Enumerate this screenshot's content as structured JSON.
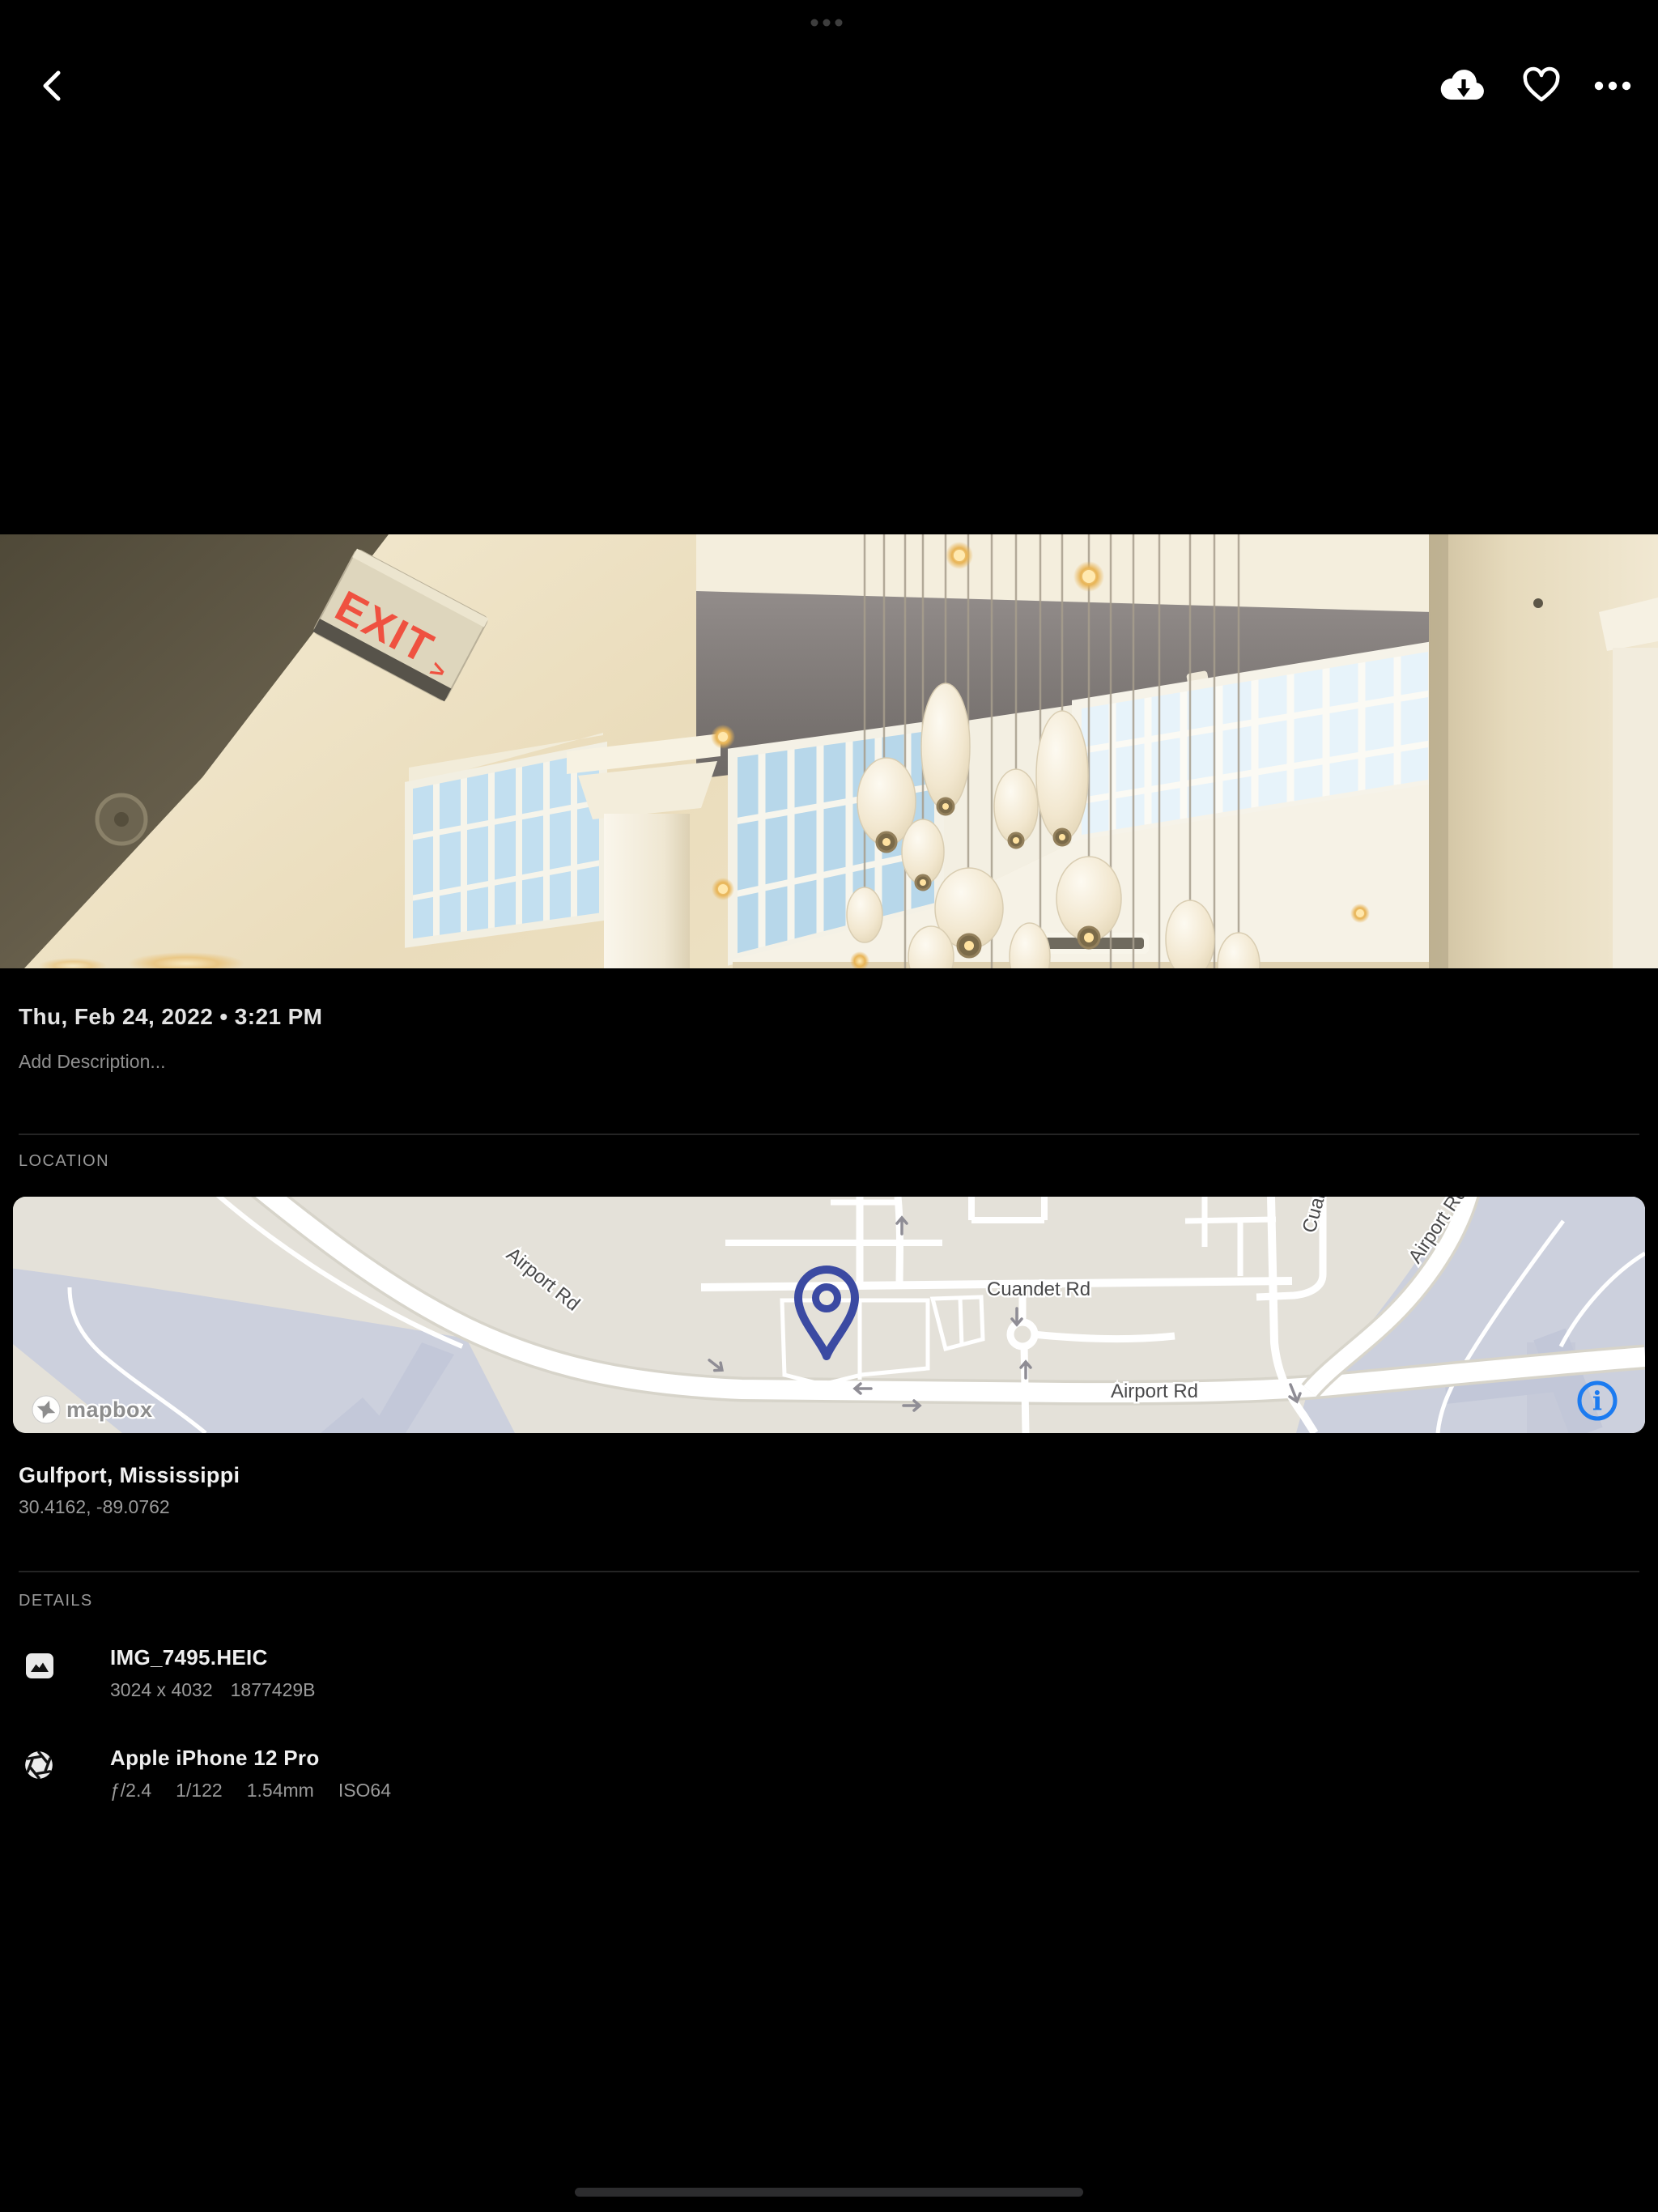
{
  "top_bar": {
    "back_icon": "chevron-left",
    "download_icon": "cloud-download",
    "favorite_icon": "heart-outline",
    "more_icon": "ellipsis-horizontal",
    "multitask_indicator_icon": "three-dots"
  },
  "photo": {
    "exit_sign_text": "EXIT",
    "exit_sign_arrow": ">"
  },
  "meta": {
    "datetime": "Thu, Feb 24, 2022 • 3:21 PM",
    "description_placeholder": "Add Description..."
  },
  "location": {
    "section_label": "LOCATION",
    "place": "Gulfport, Mississippi",
    "coordinates": "30.4162, -89.0762",
    "map": {
      "road_labels": {
        "airport_diagonal": "Airport Rd",
        "cuandet": "Cuandet Rd",
        "airport_bottom": "Airport Rd",
        "airport_right_partial": "Airport Rd",
        "cuandet_top_partial": "Cuandet Rd"
      },
      "attribution": "mapbox",
      "info_symbol": "i",
      "land_color": "#e4e1d9",
      "zone_color": "#ccd0dd",
      "pin_color": "#3b4aa2",
      "info_color": "#1c7bf0"
    }
  },
  "details": {
    "section_label": "DETAILS",
    "file": {
      "name": "IMG_7495.HEIC",
      "dimensions": "3024 x 4032",
      "size": "1877429B"
    },
    "camera": {
      "model": "Apple iPhone 12 Pro",
      "aperture": "ƒ/2.4",
      "shutter_speed": "1/122",
      "focal_length": "1.54mm",
      "iso": "ISO64"
    }
  },
  "colors": {
    "background": "#000000",
    "text_primary": "#efefef",
    "text_secondary": "#999999",
    "divider": "#242424",
    "accent_blue": "#1c7bf0",
    "pin_blue": "#3b4aa2"
  }
}
